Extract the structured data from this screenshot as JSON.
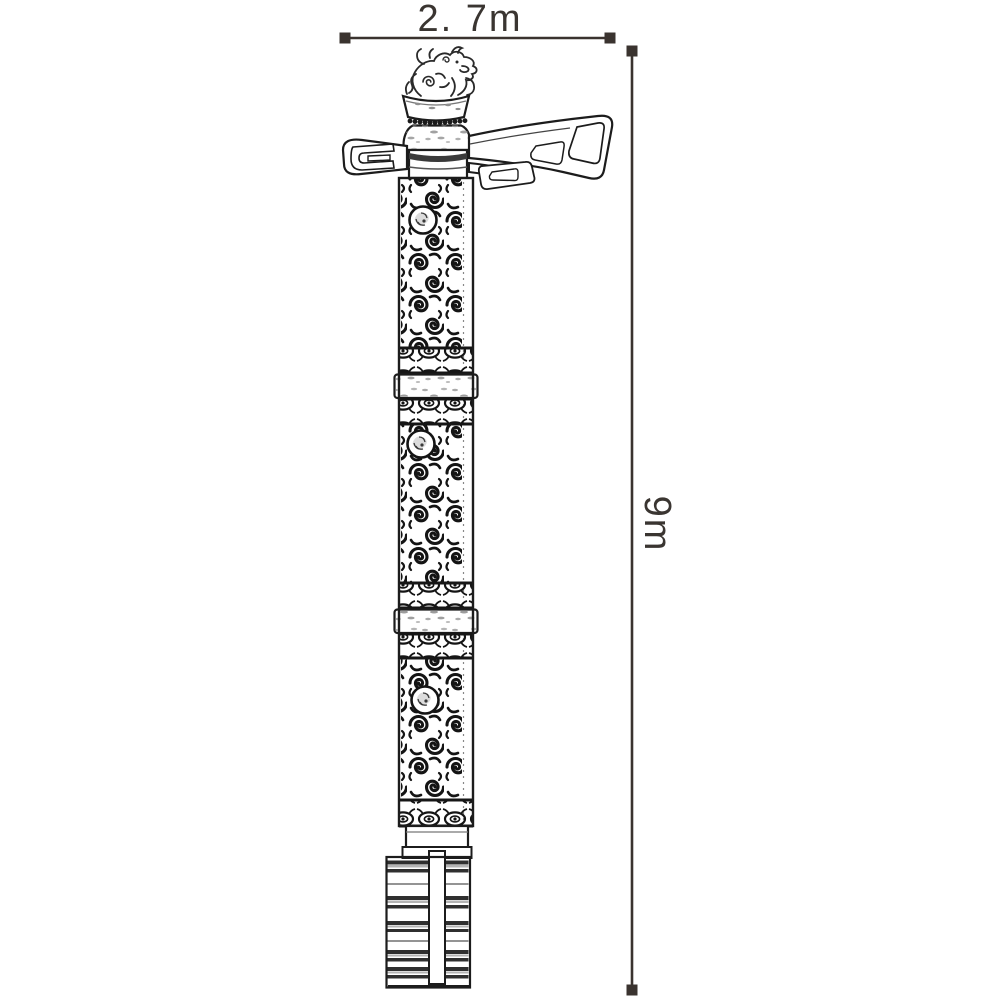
{
  "drawing": {
    "width_dimension_label": "2. 7m",
    "height_dimension_label": "9m"
  },
  "colors": {
    "ink": "#1c1c1c",
    "dimension_line": "#3a332f",
    "label_text": "#3a3531",
    "background": "#ffffff"
  }
}
